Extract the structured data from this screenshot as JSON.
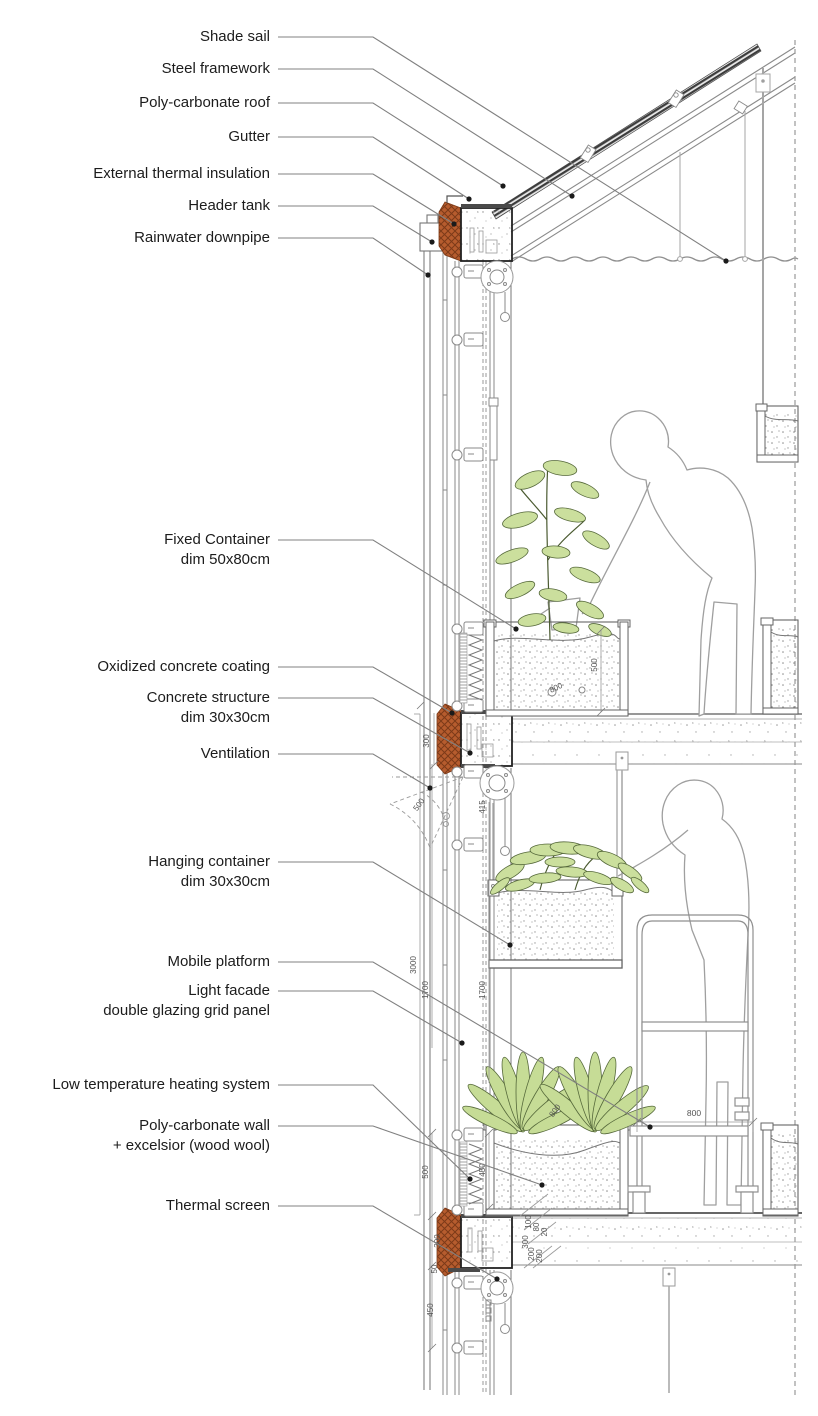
{
  "callouts": {
    "shade_sail": {
      "l1": "Shade sail"
    },
    "steel_framework": {
      "l1": "Steel framework"
    },
    "poly_roof": {
      "l1": "Poly-carbonate roof"
    },
    "gutter": {
      "l1": "Gutter"
    },
    "ext_insulation": {
      "l1": "External thermal insulation"
    },
    "header_tank": {
      "l1": "Header tank"
    },
    "rain_downpipe": {
      "l1": "Rainwater downpipe"
    },
    "fixed_container": {
      "l1": "Fixed Container",
      "l2": "dim 50x80cm"
    },
    "oxidized": {
      "l1": "Oxidized concrete coating"
    },
    "concrete_struct": {
      "l1": "Concrete structure",
      "l2": "dim 30x30cm"
    },
    "ventilation": {
      "l1": "Ventilation"
    },
    "hanging_container": {
      "l1": "Hanging container",
      "l2": "dim 30x30cm"
    },
    "mobile_platform": {
      "l1": "Mobile platform"
    },
    "light_facade": {
      "l1": "Light facade",
      "l2": "double glazing grid panel"
    },
    "heating": {
      "l1": "Low temperature heating system"
    },
    "poly_wall": {
      "l1": "Poly-carbonate wall",
      "l2": "+ excelsior (wood wool)"
    },
    "thermal_screen": {
      "l1": "Thermal screen"
    }
  },
  "dims": {
    "mid_node_h": "300",
    "vent_radius": "500",
    "story": "3000",
    "glazing_a": "1700",
    "glazing_b": "1700",
    "container_h": "500",
    "container_w": "800",
    "hang": "415",
    "low_glass": "500",
    "heater": "450",
    "bot_node": "300",
    "gap": "50",
    "below": "450",
    "fl_100": "100",
    "fl_80": "80",
    "fl_20": "20",
    "fl_300": "300",
    "fl_200a": "200",
    "fl_200b": "200",
    "platform_w": "800",
    "bot_container_w": "800"
  },
  "colors": {
    "oxidized_concrete": "#b65c2e",
    "oxidized_hatch": "#7c3a18",
    "leaf_fill": "#cbdf9d",
    "leaf_stroke": "#55683a",
    "line": "#666666",
    "leader": "#808080"
  }
}
